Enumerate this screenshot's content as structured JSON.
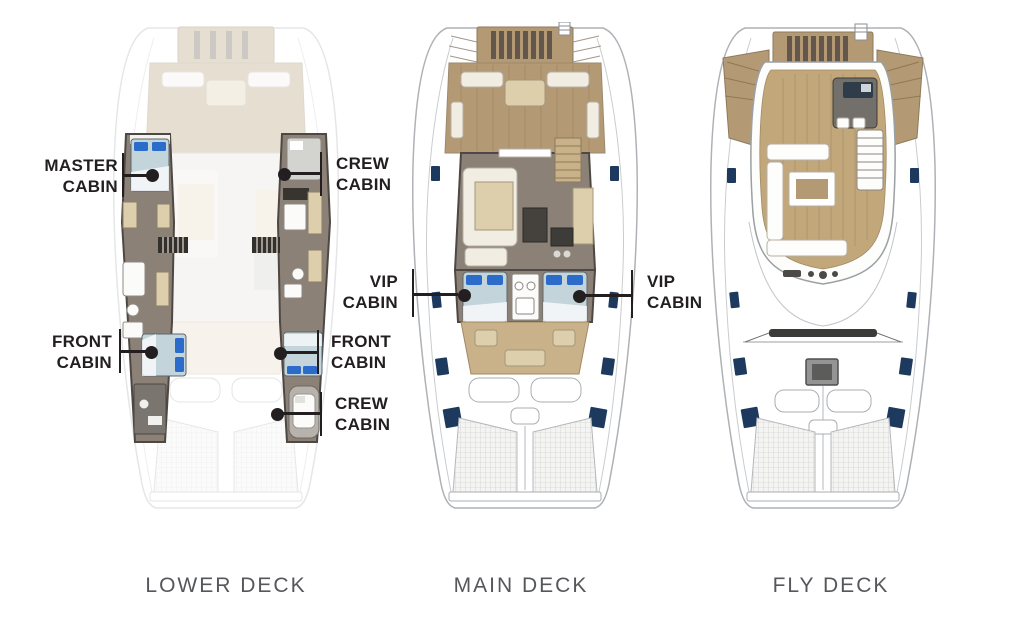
{
  "decks": [
    {
      "name": "LOWER DECK"
    },
    {
      "name": "MAIN DECK"
    },
    {
      "name": "FLY DECK"
    }
  ],
  "callouts": {
    "master": {
      "line1": "MASTER",
      "line2": "CABIN"
    },
    "crew_aft": {
      "line1": "CREW",
      "line2": "CABIN"
    },
    "front_port": {
      "line1": "FRONT",
      "line2": "CABIN"
    },
    "front_stbd": {
      "line1": "FRONT",
      "line2": "CABIN"
    },
    "crew_bow": {
      "line1": "CREW",
      "line2": "CABIN"
    },
    "vip_port": {
      "line1": "VIP",
      "line2": "CABIN"
    },
    "vip_stbd": {
      "line1": "VIP",
      "line2": "CABIN"
    }
  },
  "colors": {
    "label_text": "#231f20",
    "leader": "#231f20",
    "deck_title": "#56575b",
    "wood": "#b49a74",
    "wood_light": "#c9b189",
    "wood_dark": "#8d7a5c",
    "floor": "#8b8177",
    "wall": "#4d4843",
    "bed": "#c3d4da",
    "pillow": "#2b6bc9",
    "window": "#1d3a5e",
    "beige": "#ddceac",
    "cream": "#f1ede3",
    "hull_line": "#aeb2b6",
    "tramp_bg": "#f4f4f3",
    "tramp_grid": "#d3d3d0"
  }
}
